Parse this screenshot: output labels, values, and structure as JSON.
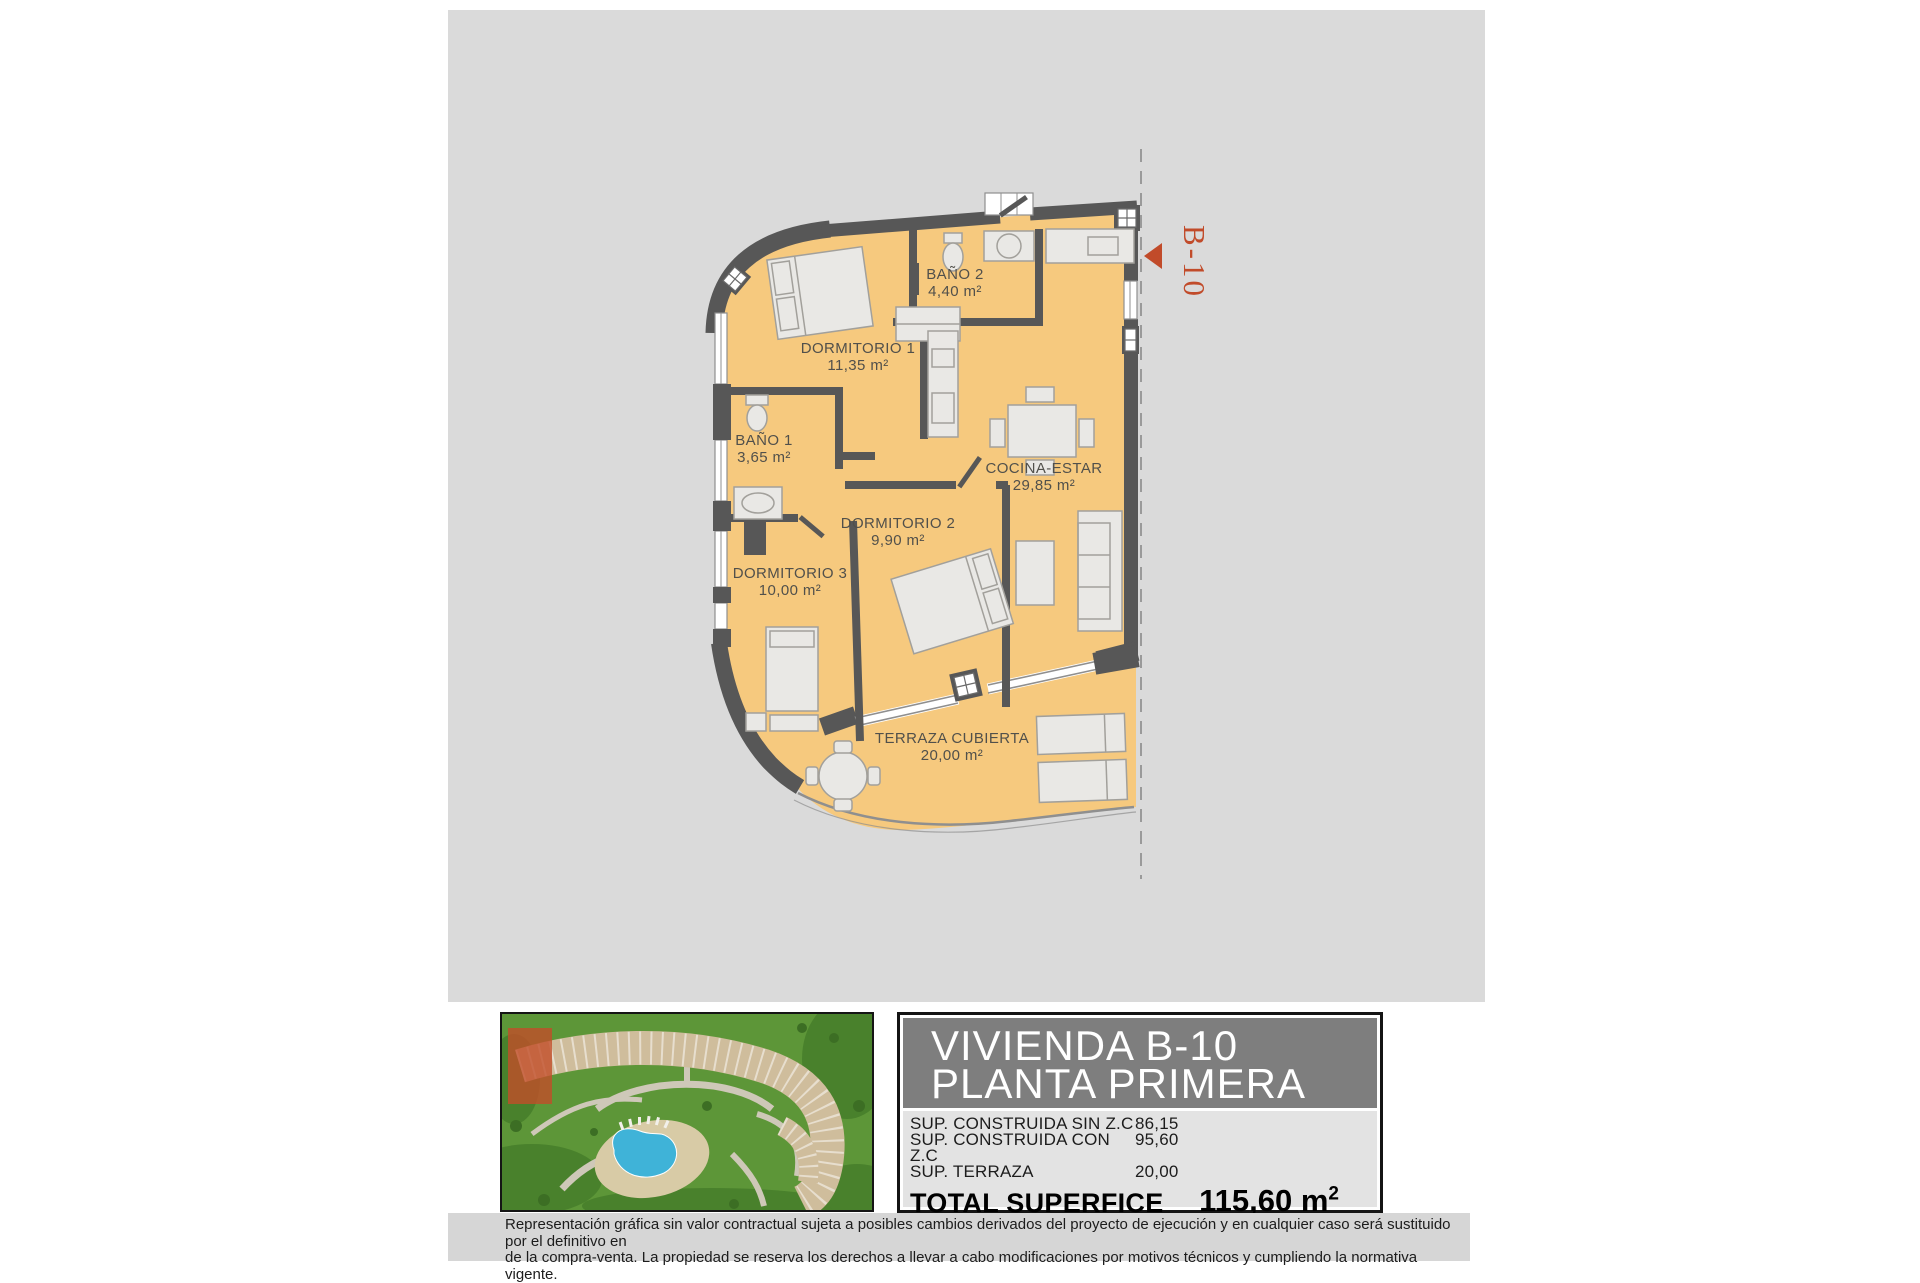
{
  "plan": {
    "unit_marker": {
      "label": "B-10",
      "color": "#c14b2a"
    },
    "floor_color": "#f6c97e",
    "wall_color": "#575757",
    "rooms": [
      {
        "name": "DORMITORIO 1",
        "area": "11,35 m²",
        "x": 858,
        "y": 352
      },
      {
        "name": "BAÑO 2",
        "area": "4,40 m²",
        "x": 955,
        "y": 278
      },
      {
        "name": "BAÑO 1",
        "area": "3,65 m²",
        "x": 764,
        "y": 444
      },
      {
        "name": "COCINA-ESTAR",
        "area": "29,85 m²",
        "x": 1044,
        "y": 472
      },
      {
        "name": "DORMITORIO 2",
        "area": "9,90 m²",
        "x": 898,
        "y": 527
      },
      {
        "name": "DORMITORIO 3",
        "area": "10,00 m²",
        "x": 790,
        "y": 577
      },
      {
        "name": "TERRAZA CUBIERTA",
        "area": "20,00 m²",
        "x": 952,
        "y": 742
      }
    ]
  },
  "panel": {
    "title_line1": "VIVIENDA B-10",
    "title_line2": "PLANTA PRIMERA",
    "rows": [
      {
        "label": "SUP. CONSTRUIDA SIN Z.C",
        "value": "86,15"
      },
      {
        "label": "SUP. CONSTRUIDA CON Z.C",
        "value": "95,60"
      },
      {
        "label": "SUP. TERRAZA",
        "value": "20,00"
      }
    ],
    "total_label": "TOTAL SUPERFICE",
    "total_value": "115,60 m",
    "total_sup": "2"
  },
  "disclaimer": {
    "line1": "Representación gráfica sin valor contractual sujeta a posibles cambios derivados del proyecto de ejecución y en cualquier caso será sustituido por el definitivo en",
    "line2": "de la compra-venta. La propiedad se reserva los derechos a llevar a cabo modificaciones por motivos técnicos y cumpliendo la normativa vigente."
  }
}
